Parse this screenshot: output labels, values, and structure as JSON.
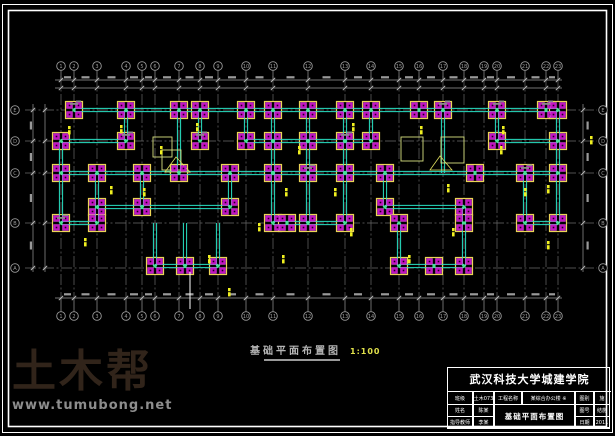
{
  "watermark": {
    "logo": "土木帮",
    "url": "www.tumubong.net"
  },
  "drawing_title": {
    "text": "基础平面布置图",
    "scale": "1:100"
  },
  "title_block": {
    "school": "武汉科技大学城建学院",
    "class": {
      "label": "班级",
      "value": "土木073"
    },
    "project": {
      "label": "工程名称",
      "value": "某综合办公楼 ※"
    },
    "type": {
      "label": "图别",
      "value": "施"
    },
    "name": {
      "label": "姓名",
      "value": "陈某"
    },
    "figure": {
      "label": "图名",
      "value": "基础平面布置图"
    },
    "number": {
      "label": "图号",
      "value": "结施"
    },
    "advisor": {
      "label": "指导教师",
      "value": "李某"
    },
    "date": {
      "label": "日期",
      "value": "2011"
    }
  },
  "colors": {
    "background": "#000000",
    "frame": "#ffffff",
    "grid": "#6a6a6a",
    "dimension": "#9a9a9a",
    "beam": "#28e2c4",
    "cap_outline": "#ecd456",
    "pile": "#c414c4",
    "node": "#4ae08c",
    "tag": "#f0f020",
    "scale_text": "#e0e04a",
    "watermark_logo": "#31241a",
    "watermark_url": "#8d8d8d"
  },
  "plan": {
    "cols": [
      61,
      74,
      97,
      126,
      142,
      155,
      179,
      200,
      218,
      246,
      273,
      308,
      345,
      371,
      399,
      419,
      443,
      464,
      484,
      497,
      525,
      546,
      558
    ],
    "col_labels": [
      "1",
      "2",
      "3",
      "4",
      "5",
      "6",
      "7",
      "8",
      "9",
      "10",
      "11",
      "12",
      "13",
      "14",
      "15",
      "16",
      "17",
      "18",
      "19",
      "20",
      "21",
      "22",
      "23"
    ],
    "rows": [
      110,
      141,
      173,
      223,
      268
    ],
    "row_labels": [
      "E",
      "D",
      "C",
      "B",
      "A"
    ],
    "caps": [
      [
        74,
        110
      ],
      [
        126,
        110
      ],
      [
        179,
        110
      ],
      [
        200,
        110
      ],
      [
        246,
        110
      ],
      [
        273,
        110
      ],
      [
        308,
        110
      ],
      [
        345,
        110
      ],
      [
        371,
        110
      ],
      [
        419,
        110
      ],
      [
        443,
        110
      ],
      [
        497,
        110
      ],
      [
        546,
        110
      ],
      [
        558,
        110
      ],
      [
        61,
        141
      ],
      [
        126,
        141
      ],
      [
        200,
        141
      ],
      [
        246,
        141
      ],
      [
        273,
        141
      ],
      [
        308,
        141
      ],
      [
        345,
        141
      ],
      [
        371,
        141
      ],
      [
        497,
        141
      ],
      [
        558,
        141
      ],
      [
        61,
        173
      ],
      [
        97,
        173
      ],
      [
        142,
        173
      ],
      [
        179,
        173
      ],
      [
        230,
        173
      ],
      [
        273,
        173
      ],
      [
        308,
        173
      ],
      [
        345,
        173
      ],
      [
        385,
        173
      ],
      [
        475,
        173
      ],
      [
        525,
        173
      ],
      [
        558,
        173
      ],
      [
        97,
        207
      ],
      [
        142,
        207
      ],
      [
        230,
        207
      ],
      [
        385,
        207
      ],
      [
        464,
        207
      ],
      [
        61,
        223
      ],
      [
        97,
        223
      ],
      [
        273,
        223
      ],
      [
        287,
        223
      ],
      [
        308,
        223
      ],
      [
        345,
        223
      ],
      [
        399,
        223
      ],
      [
        464,
        223
      ],
      [
        525,
        223
      ],
      [
        558,
        223
      ],
      [
        155,
        266
      ],
      [
        185,
        266
      ],
      [
        218,
        266
      ],
      [
        399,
        266
      ],
      [
        434,
        266
      ],
      [
        464,
        266
      ]
    ],
    "beams_h": [
      [
        110,
        74,
        558
      ],
      [
        141,
        61,
        126
      ],
      [
        141,
        246,
        371
      ],
      [
        141,
        497,
        558
      ],
      [
        173,
        61,
        558
      ],
      [
        207,
        97,
        230
      ],
      [
        207,
        385,
        464
      ],
      [
        223,
        61,
        97
      ],
      [
        223,
        273,
        345
      ],
      [
        223,
        525,
        558
      ],
      [
        266,
        155,
        218
      ],
      [
        266,
        399,
        464
      ]
    ],
    "beams_v": [
      [
        61,
        141,
        223
      ],
      [
        97,
        173,
        223
      ],
      [
        126,
        110,
        141
      ],
      [
        142,
        173,
        207
      ],
      [
        155,
        223,
        266
      ],
      [
        179,
        110,
        173
      ],
      [
        185,
        223,
        266
      ],
      [
        200,
        110,
        141
      ],
      [
        218,
        223,
        266
      ],
      [
        230,
        173,
        207
      ],
      [
        246,
        110,
        141
      ],
      [
        273,
        110,
        223
      ],
      [
        308,
        110,
        223
      ],
      [
        345,
        110,
        223
      ],
      [
        371,
        110,
        141
      ],
      [
        385,
        173,
        207
      ],
      [
        399,
        223,
        266
      ],
      [
        443,
        110,
        173
      ],
      [
        464,
        207,
        266
      ],
      [
        497,
        110,
        141
      ],
      [
        525,
        173,
        223
      ],
      [
        558,
        110,
        223
      ]
    ],
    "boxes": [
      [
        153,
        137,
        19,
        20
      ],
      [
        162,
        150,
        19,
        20
      ],
      [
        401,
        137,
        22,
        24
      ],
      [
        441,
        137,
        23,
        26
      ]
    ],
    "triangles": [
      [
        [
          165,
          172
        ],
        [
          176,
          157
        ],
        [
          190,
          172
        ]
      ],
      [
        [
          430,
          170
        ],
        [
          440,
          156
        ],
        [
          452,
          170
        ]
      ]
    ],
    "tags": [
      [
        68,
        126
      ],
      [
        120,
        125
      ],
      [
        196,
        123
      ],
      [
        160,
        146
      ],
      [
        110,
        186
      ],
      [
        84,
        238
      ],
      [
        143,
        188
      ],
      [
        208,
        255
      ],
      [
        228,
        288
      ],
      [
        285,
        188
      ],
      [
        298,
        146
      ],
      [
        334,
        188
      ],
      [
        352,
        123
      ],
      [
        420,
        126
      ],
      [
        447,
        184
      ],
      [
        502,
        126
      ],
      [
        524,
        188
      ],
      [
        547,
        185
      ],
      [
        547,
        241
      ],
      [
        350,
        228
      ],
      [
        452,
        228
      ],
      [
        282,
        255
      ],
      [
        408,
        255
      ],
      [
        500,
        146
      ],
      [
        258,
        223
      ],
      [
        590,
        136
      ]
    ],
    "gray_marks": [
      [
        74,
        103
      ],
      [
        126,
        134
      ],
      [
        200,
        134
      ],
      [
        308,
        167
      ],
      [
        345,
        134
      ],
      [
        443,
        103
      ],
      [
        497,
        103
      ],
      [
        546,
        103
      ],
      [
        61,
        217
      ],
      [
        525,
        167
      ]
    ],
    "cursor": {
      "x": 190,
      "y1": 272,
      "y2": 309
    }
  }
}
